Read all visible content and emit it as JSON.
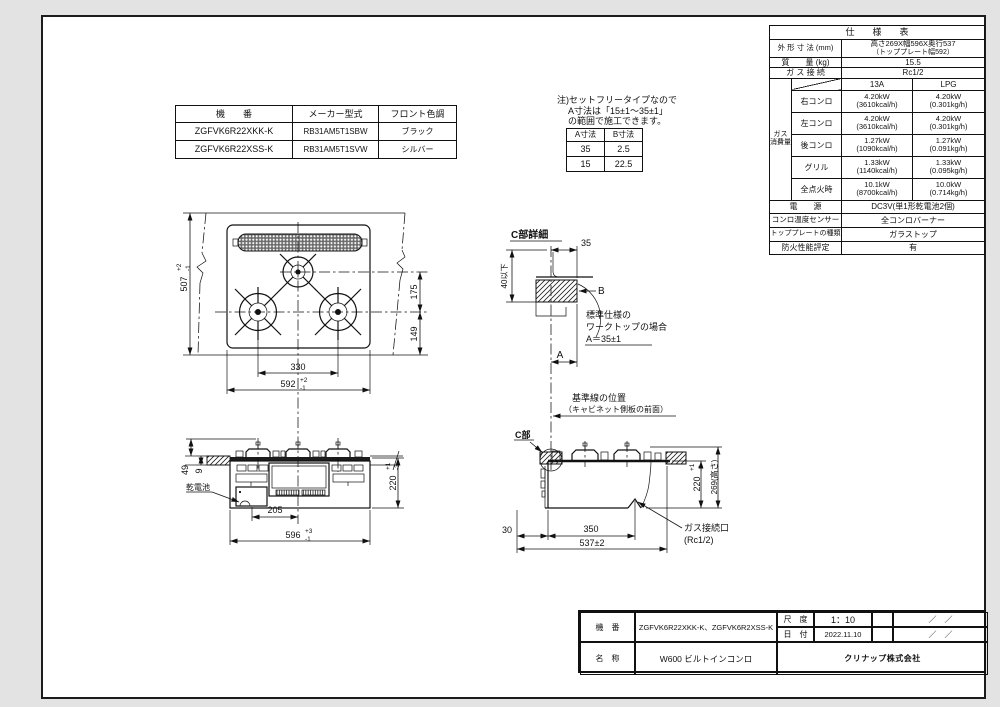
{
  "models": {
    "h1": "機　　番",
    "h2": "メーカー型式",
    "h3": "フロント色調",
    "r1c1": "ZGFVK6R22XKK-K",
    "r1c2": "RB31AM5T1SBW",
    "r1c3": "ブラック",
    "r2c1": "ZGFVK6R22XSS-K",
    "r2c2": "RB31AM5T1SVW",
    "r2c3": "シルバー"
  },
  "note": {
    "line1": "注)セットフリータイプなので",
    "line2": "A寸法は「15±1～35±1」",
    "line3": "の範囲で施工できます。",
    "ab_h1": "A寸法",
    "ab_h2": "B寸法",
    "ab_r1c1": "35",
    "ab_r1c2": "2.5",
    "ab_r2c1": "15",
    "ab_r2c2": "22.5"
  },
  "spec": {
    "title": "仕　　様　　表",
    "outer_dim_label": "外 形 寸 法 (mm)",
    "outer_dim_line1": "高さ269X幅596X奥行537",
    "outer_dim_line2": "（トッププレート幅592）",
    "mass_label": "質　　量 (kg)",
    "mass_value": "15.5",
    "gas_conn_label": "ガ ス 接 続",
    "gas_conn_value": "Rc1/2",
    "col_13a": "13A",
    "col_lpg": "LPG",
    "group_label_1": "ガス",
    "group_label_2": "消費量",
    "r1_label": "右コンロ",
    "r1_a1": "4.20kW",
    "r1_a2": "(3610kcal/h)",
    "r1_b1": "4.20kW",
    "r1_b2": "(0.301kg/h)",
    "r2_label": "左コンロ",
    "r2_a1": "4.20kW",
    "r2_a2": "(3610kcal/h)",
    "r2_b1": "4.20kW",
    "r2_b2": "(0.301kg/h)",
    "r3_label": "後コンロ",
    "r3_a1": "1.27kW",
    "r3_a2": "(1090kcal/h)",
    "r3_b1": "1.27kW",
    "r3_b2": "(0.091kg/h)",
    "r4_label": "グリル",
    "r4_a1": "1.33kW",
    "r4_a2": "(1140kcal/h)",
    "r4_b1": "1.33kW",
    "r4_b2": "(0.095kg/h)",
    "r5_label": "全点火時",
    "r5_a1": "10.1kW",
    "r5_a2": "(8700kcal/h)",
    "r5_b1": "10.0kW",
    "r5_b2": "(0.714kg/h)",
    "power_label": "電　　源",
    "power_value": "DC3V(単1形乾電池2個)",
    "sensor_label": "コンロ温度センサー",
    "sensor_value": "全コンロバーナー",
    "plate_label": "トッププレートの種類",
    "plate_value": "ガラストップ",
    "fire_label": "防火性能評定",
    "fire_value": "有"
  },
  "plan": {
    "d507": "507",
    "d507_tp": "+2",
    "d507_tm": "-1",
    "d175": "175",
    "d149": "149",
    "d330": "330",
    "d592": "592",
    "d592_tp": "+2",
    "d592_tm": "-1"
  },
  "cdetail": {
    "title": "C部詳細",
    "d35": "35",
    "d40": "40以下",
    "b": "B",
    "a": "A",
    "note1": "標準仕様の",
    "note2": "ワークトップの場合",
    "note3": "A＝35±1"
  },
  "refline": {
    "line1": "基準線の位置",
    "line2": "（キャビネット側板の前面）",
    "clabel": "C部"
  },
  "front": {
    "d49": "49",
    "d9": "9",
    "battery": "乾電池",
    "d205": "205",
    "d596": "596",
    "d596_tp": "+3",
    "d596_tm": "-1",
    "d220": "220",
    "d220_tp": "+1",
    "d220_tm": "-3"
  },
  "side": {
    "d30": "30",
    "d350": "350",
    "d537": "537±2",
    "d220": "220",
    "d220_tp": "+1",
    "d220_tm": "-3",
    "d269": "269(高さ)",
    "gas1": "ガス接続口",
    "gas2": "(Rc1/2)"
  },
  "titleblock": {
    "kiban_label": "機　番",
    "kiban_value": "ZGFVK6R22XKK-K、ZGFVK6R2XSS-K",
    "scale_label": "尺　度",
    "scale_value": "1：10",
    "date_label": "日　付",
    "date_value": "2022.11.10",
    "slash1": "／　／",
    "slash2": "／　／",
    "name_label": "名　称",
    "name_value": "W600 ビルトインコンロ",
    "company": "クリナップ株式会社"
  }
}
